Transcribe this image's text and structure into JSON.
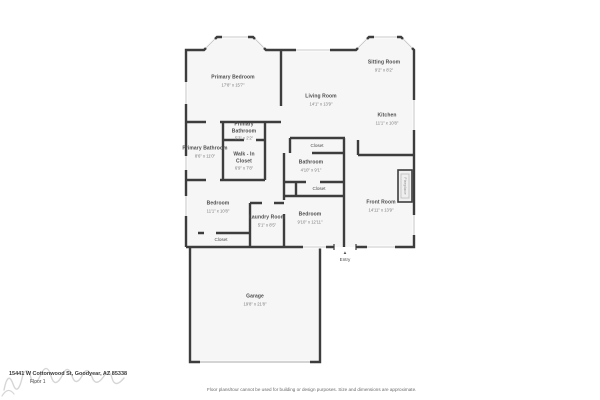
{
  "rooms": {
    "primary_bedroom": {
      "name": "Primary Bedroom",
      "dims": "17'8\" x 15'7\""
    },
    "living_room": {
      "name": "Living Room",
      "dims": "14'1\" x 13'9\""
    },
    "sitting_room": {
      "name": "Sitting Room",
      "dims": "9'2\" x 8'2\""
    },
    "kitchen": {
      "name": "Kitchen",
      "dims": "11'1\" x 10'8\""
    },
    "primary_bathroom_upper": {
      "name": "Primary Bathroom",
      "dims": "5'3\" x 2'2\""
    },
    "primary_bathroom": {
      "name": "Primary Bathroom",
      "dims": "8'6\" x 11'0\""
    },
    "walk_in_closet": {
      "name": "Walk - In Closet",
      "dims": "6'9\" x 7'8\""
    },
    "closet_hall": {
      "name": "Closet"
    },
    "bathroom": {
      "name": "Bathroom",
      "dims": "4'10\" x 9'1\""
    },
    "closet_small": {
      "name": "Closet"
    },
    "front_room": {
      "name": "Front Room",
      "dims": "14'11\" x 13'9\""
    },
    "bedroom_left": {
      "name": "Bedroom",
      "dims": "11'1\" x 10'8\""
    },
    "laundry_room": {
      "name": "Laundry Room",
      "dims": "5'1\" x 8'5\""
    },
    "bedroom_middle": {
      "name": "Bedroom",
      "dims": "9'10\" x 12'11\""
    },
    "closet_bedroom": {
      "name": "Closet"
    },
    "garage": {
      "name": "Garage",
      "dims": "19'8\" x 21'8\""
    }
  },
  "features": {
    "fireplace_label": "Fireplace",
    "entry_label": "Entry",
    "entry_arrow": "▲"
  },
  "footer": {
    "address": "15441 W Cottonwood St, Goodyear, AZ 85338",
    "floor_label": "Floor 1",
    "disclaimer": "Floor plans/tour cannot be used for building or design purposes. Size and dimensions are approximate."
  },
  "colors": {
    "wall": "#3d3d3d",
    "room_fill": "#f6f6f6",
    "window": "#c9c9c9",
    "label_text": "#4c4c4c",
    "dims_text": "#7a7a7a"
  }
}
